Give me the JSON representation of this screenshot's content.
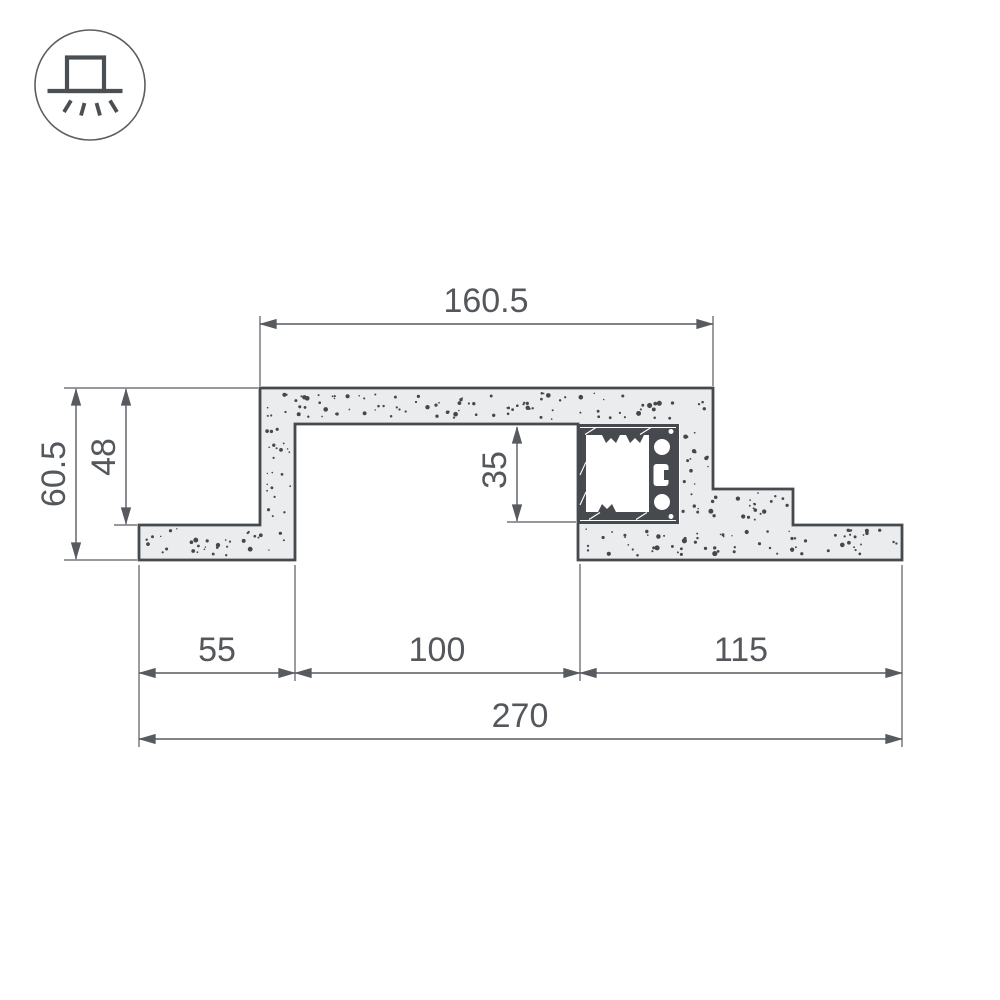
{
  "page": {
    "background": "#ffffff"
  },
  "badge_icon": {
    "name": "recessed-downlight"
  },
  "colors": {
    "background": "#ffffff",
    "outline": "#46494d",
    "dimension": "#575b5f",
    "text": "#54585c",
    "plaster_fill": "#ebeced",
    "speckle": "#44484c",
    "white": "#ffffff"
  },
  "drawing": {
    "type": "plasterboard-niche-cross-section-with-led-profile",
    "dimensions": {
      "top_width": {
        "label": "160.5"
      },
      "total_height": {
        "label": "60.5"
      },
      "niche_height": {
        "label": "48"
      },
      "profile_height": {
        "label": "35"
      },
      "bottom_left": {
        "label": "55"
      },
      "bottom_opening": {
        "label": "100"
      },
      "bottom_right": {
        "label": "115"
      },
      "total_width": {
        "label": "270"
      }
    }
  }
}
